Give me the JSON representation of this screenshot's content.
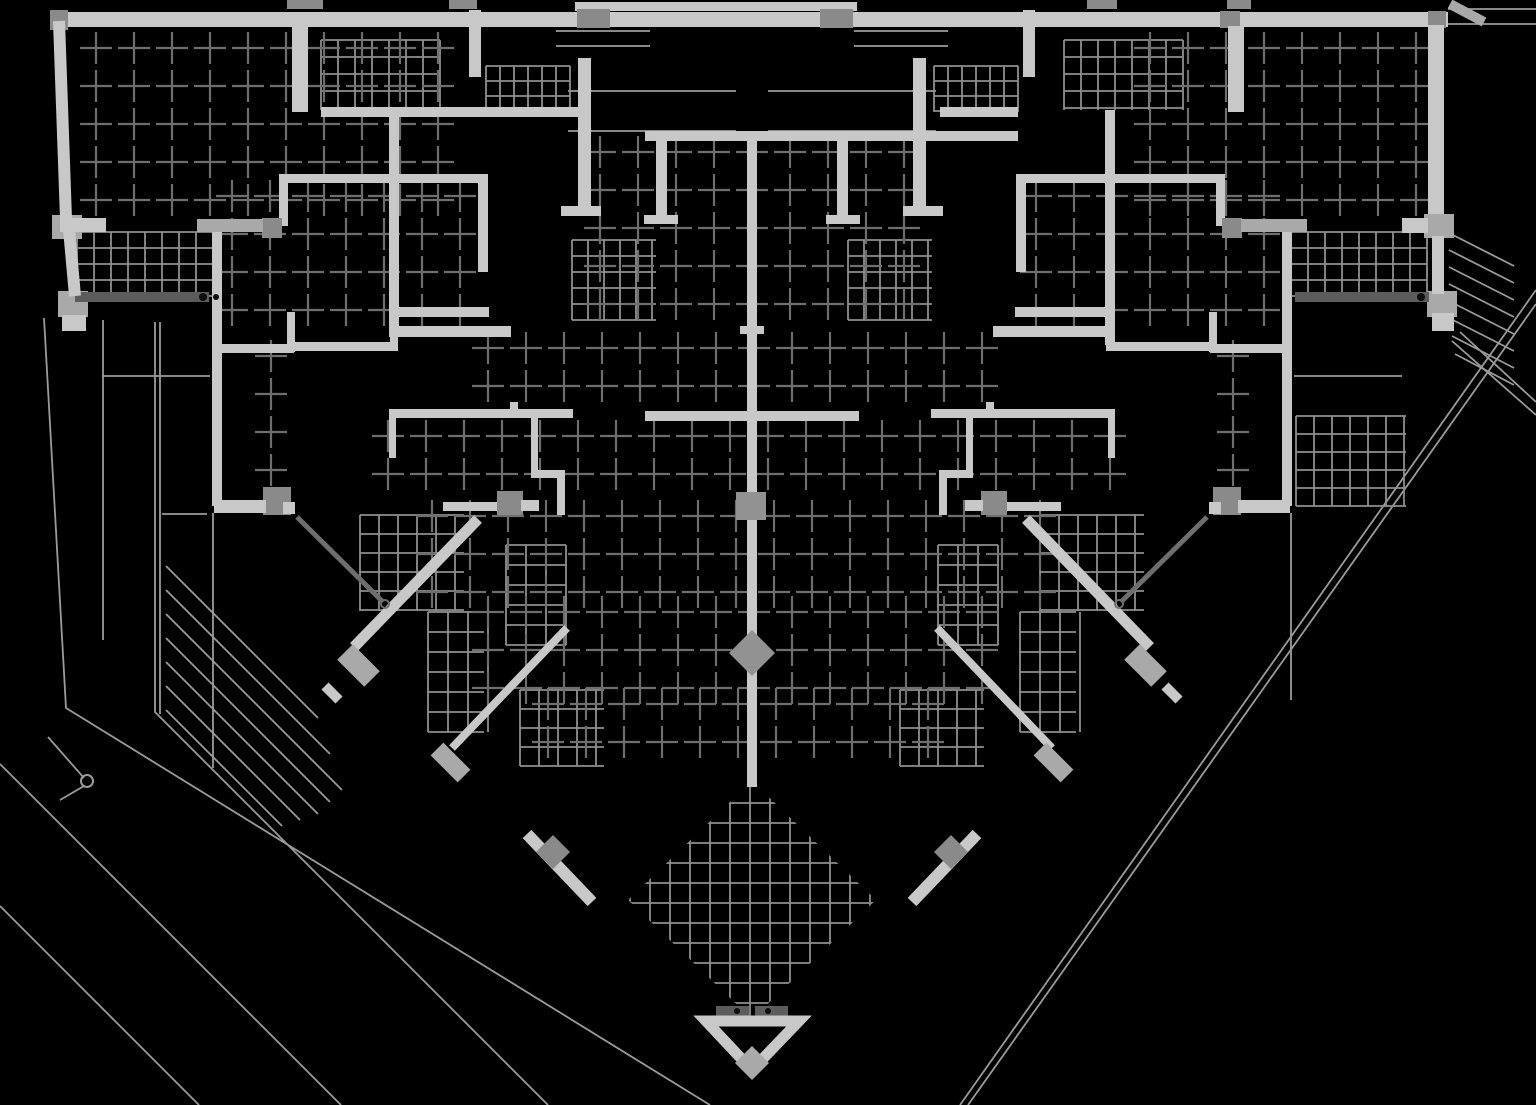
{
  "meta": {
    "drawing_type": "architectural-floor-plan",
    "style": "cad-inverted-white-on-black"
  },
  "canvas": {
    "w": 1536,
    "h": 1105,
    "bg": "#000000"
  },
  "palette": {
    "bg": "#000000",
    "wall": "#c8c8c8",
    "wallDim": "#a9a9a9",
    "joint": "#8a8a8a",
    "rail": "#5c5c5c",
    "node": "#929292",
    "mesh": "#8f8f8f",
    "cross": "#6e6e6e",
    "thin": "#9b9b9b",
    "door": "#6e6e6e",
    "dot": "#0d0d0d"
  },
  "plan": {
    "rects": [
      [
        50,
        12,
        1398,
        15,
        "w"
      ],
      [
        575,
        2,
        282,
        9,
        "w"
      ],
      [
        287,
        0,
        36,
        9,
        "j"
      ],
      [
        449,
        0,
        28,
        9,
        "j"
      ],
      [
        1087,
        0,
        30,
        9,
        "j"
      ],
      [
        1227,
        0,
        24,
        9,
        "j"
      ],
      [
        50,
        10,
        18,
        20,
        "j"
      ],
      [
        577,
        9,
        33,
        19,
        "j"
      ],
      [
        820,
        9,
        33,
        19,
        "j"
      ],
      [
        1220,
        11,
        20,
        17,
        "j"
      ],
      [
        1428,
        11,
        18,
        17,
        "j"
      ],
      [
        52,
        215,
        30,
        24,
        "d"
      ],
      [
        58,
        291,
        30,
        26,
        "d"
      ],
      [
        62,
        315,
        24,
        16,
        "w"
      ],
      [
        60,
        218,
        46,
        14,
        "w"
      ],
      [
        1428,
        25,
        16,
        196,
        "w"
      ],
      [
        1424,
        214,
        30,
        24,
        "d"
      ],
      [
        1427,
        291,
        30,
        26,
        "d"
      ],
      [
        1432,
        313,
        22,
        18,
        "w"
      ],
      [
        1402,
        218,
        26,
        15,
        "w"
      ],
      [
        1432,
        236,
        12,
        58,
        "w"
      ],
      [
        292,
        26,
        16,
        86,
        "w"
      ],
      [
        1228,
        26,
        16,
        86,
        "w"
      ],
      [
        321,
        107,
        268,
        10,
        "w"
      ],
      [
        940,
        107,
        78,
        10,
        "w"
      ],
      [
        389,
        110,
        10,
        227,
        "w"
      ],
      [
        1105,
        110,
        10,
        235,
        "w"
      ],
      [
        469,
        10,
        12,
        67,
        "w"
      ],
      [
        1023,
        10,
        12,
        67,
        "w"
      ],
      [
        578,
        58,
        13,
        154,
        "w"
      ],
      [
        913,
        58,
        13,
        154,
        "w"
      ],
      [
        561,
        206,
        40,
        10,
        "w"
      ],
      [
        903,
        206,
        40,
        10,
        "w"
      ],
      [
        645,
        131,
        212,
        10,
        "w"
      ],
      [
        857,
        131,
        161,
        10,
        "w"
      ],
      [
        656,
        141,
        11,
        78,
        "w"
      ],
      [
        837,
        141,
        11,
        78,
        "w"
      ],
      [
        644,
        215,
        34,
        9,
        "w"
      ],
      [
        826,
        215,
        34,
        9,
        "w"
      ],
      [
        747,
        141,
        10,
        190,
        "w"
      ],
      [
        389,
        326,
        122,
        11,
        "w"
      ],
      [
        993,
        326,
        122,
        11,
        "w"
      ],
      [
        212,
        222,
        10,
        284,
        "w"
      ],
      [
        1282,
        222,
        10,
        284,
        "w"
      ],
      [
        212,
        344,
        82,
        9,
        "w"
      ],
      [
        1210,
        344,
        82,
        9,
        "w"
      ],
      [
        287,
        312,
        8,
        40,
        "w"
      ],
      [
        1209,
        312,
        8,
        40,
        "w"
      ],
      [
        293,
        342,
        105,
        9,
        "w"
      ],
      [
        1106,
        342,
        105,
        9,
        "w"
      ],
      [
        390,
        307,
        8,
        44,
        "w"
      ],
      [
        1106,
        307,
        8,
        44,
        "w"
      ],
      [
        390,
        307,
        99,
        10,
        "w"
      ],
      [
        1015,
        307,
        99,
        10,
        "w"
      ],
      [
        279,
        174,
        208,
        9,
        "w"
      ],
      [
        1017,
        174,
        208,
        9,
        "w"
      ],
      [
        279,
        174,
        9,
        52,
        "w"
      ],
      [
        1216,
        174,
        9,
        52,
        "w"
      ],
      [
        478,
        174,
        10,
        98,
        "w"
      ],
      [
        1016,
        174,
        10,
        98,
        "w"
      ],
      [
        262,
        218,
        20,
        20,
        "j"
      ],
      [
        1222,
        218,
        20,
        20,
        "j"
      ],
      [
        197,
        219,
        66,
        13,
        "d"
      ],
      [
        1241,
        219,
        66,
        13,
        "d"
      ],
      [
        645,
        411,
        214,
        10,
        "w"
      ],
      [
        389,
        409,
        184,
        9,
        "w"
      ],
      [
        931,
        409,
        184,
        9,
        "w"
      ],
      [
        389,
        413,
        7,
        45,
        "w"
      ],
      [
        1108,
        413,
        7,
        45,
        "w"
      ],
      [
        510,
        402,
        8,
        9,
        "w"
      ],
      [
        986,
        402,
        8,
        9,
        "w"
      ],
      [
        531,
        418,
        7,
        55,
        "w"
      ],
      [
        966,
        418,
        7,
        55,
        "w"
      ],
      [
        531,
        470,
        33,
        8,
        "w"
      ],
      [
        940,
        470,
        33,
        8,
        "w"
      ],
      [
        557,
        470,
        8,
        45,
        "w"
      ],
      [
        939,
        470,
        8,
        45,
        "w"
      ],
      [
        443,
        502,
        58,
        9,
        "w"
      ],
      [
        1003,
        502,
        58,
        9,
        "w"
      ],
      [
        497,
        491,
        26,
        24,
        "j"
      ],
      [
        981,
        491,
        26,
        24,
        "j"
      ],
      [
        521,
        500,
        18,
        11,
        "w"
      ],
      [
        965,
        500,
        18,
        11,
        "w"
      ],
      [
        263,
        487,
        28,
        28,
        "j"
      ],
      [
        1213,
        487,
        28,
        28,
        "j"
      ],
      [
        214,
        500,
        52,
        13,
        "w"
      ],
      [
        1238,
        500,
        52,
        13,
        "w"
      ],
      [
        283,
        502,
        12,
        12,
        "w"
      ],
      [
        1209,
        502,
        12,
        12,
        "w"
      ],
      [
        747,
        331,
        10,
        456,
        "w"
      ],
      [
        736,
        492,
        30,
        28,
        "n"
      ],
      [
        740,
        326,
        24,
        8,
        "w"
      ],
      [
        75,
        292,
        134,
        10,
        "r"
      ],
      [
        1295,
        292,
        134,
        10,
        "r"
      ],
      [
        716,
        1006,
        33,
        10,
        "r"
      ],
      [
        755,
        1006,
        33,
        10,
        "r"
      ]
    ],
    "segs": [
      [
        59,
        21,
        66,
        219,
        12,
        "w"
      ],
      [
        69,
        229,
        75,
        296,
        12,
        "w"
      ],
      [
        297,
        517,
        383,
        602,
        5,
        "door"
      ],
      [
        1207,
        517,
        1121,
        602,
        5,
        "door"
      ],
      [
        478,
        519,
        354,
        647,
        11,
        "w"
      ],
      [
        1026,
        519,
        1150,
        647,
        11,
        "w"
      ],
      [
        345,
        652,
        372,
        679,
        22,
        "d"
      ],
      [
        1132,
        652,
        1159,
        679,
        22,
        "d"
      ],
      [
        325,
        686,
        339,
        700,
        10,
        "w"
      ],
      [
        1165,
        686,
        1179,
        700,
        10,
        "w"
      ],
      [
        567,
        628,
        452,
        748,
        8,
        "w"
      ],
      [
        937,
        628,
        1052,
        748,
        8,
        "w"
      ],
      [
        437,
        749,
        464,
        776,
        18,
        "d"
      ],
      [
        1040,
        749,
        1067,
        776,
        18,
        "d"
      ],
      [
        527,
        834,
        592,
        902,
        12,
        "w"
      ],
      [
        977,
        834,
        912,
        902,
        12,
        "w"
      ],
      [
        1450,
        4,
        1484,
        22,
        10,
        "d"
      ]
    ],
    "polygons": [
      {
        "pts": [
          [
            706,
            1021
          ],
          [
            799,
            1021
          ],
          [
            752,
            1070
          ]
        ],
        "stroke": "wall",
        "sw": 11,
        "fill": "none"
      },
      {
        "pts": [
          [
            752,
            1046
          ],
          [
            769,
            1063
          ],
          [
            752,
            1080
          ],
          [
            735,
            1063
          ]
        ],
        "fill": "wallDim"
      },
      {
        "pts": [
          [
            752,
            630
          ],
          [
            775,
            653
          ],
          [
            752,
            676
          ],
          [
            729,
            653
          ]
        ],
        "fill": "node"
      },
      {
        "pts": [
          [
            553,
            835
          ],
          [
            570,
            852
          ],
          [
            553,
            869
          ],
          [
            536,
            852
          ]
        ],
        "fill": "joint"
      },
      {
        "pts": [
          [
            951,
            835
          ],
          [
            968,
            852
          ],
          [
            951,
            869
          ],
          [
            934,
            852
          ]
        ],
        "fill": "joint"
      }
    ],
    "meshes": [
      [
        77,
        232,
        136,
        64,
        17,
        16
      ],
      [
        1291,
        232,
        136,
        64,
        17,
        16
      ],
      [
        321,
        40,
        119,
        70,
        17,
        17
      ],
      [
        1064,
        40,
        119,
        70,
        17,
        17
      ],
      [
        486,
        66,
        84,
        46,
        14,
        15
      ],
      [
        934,
        66,
        84,
        46,
        14,
        15
      ],
      [
        572,
        240,
        84,
        80,
        16,
        16
      ],
      [
        848,
        240,
        84,
        80,
        16,
        16
      ],
      [
        360,
        515,
        104,
        96,
        19,
        19
      ],
      [
        1040,
        515,
        104,
        96,
        19,
        19
      ],
      [
        506,
        545,
        60,
        100,
        20,
        20
      ],
      [
        938,
        545,
        60,
        100,
        20,
        20
      ],
      [
        428,
        612,
        56,
        120,
        20,
        20
      ],
      [
        1020,
        612,
        56,
        120,
        20,
        20
      ],
      [
        1296,
        416,
        110,
        90,
        18,
        18
      ],
      [
        520,
        690,
        84,
        76,
        19,
        19
      ],
      [
        900,
        690,
        84,
        76,
        19,
        19
      ]
    ],
    "diamond_mesh": {
      "bbox": [
        630,
        783,
        244,
        234
      ],
      "cell": 20,
      "clip": [
        [
          752,
          781
        ],
        [
          876,
          900
        ],
        [
          752,
          1019
        ],
        [
          628,
          900
        ]
      ]
    },
    "crosses": [
      [
        96,
        48,
        376,
        160
      ],
      [
        1150,
        48,
        280,
        160
      ],
      [
        232,
        196,
        236,
        136
      ],
      [
        1036,
        196,
        236,
        136
      ],
      [
        600,
        152,
        320,
        168
      ],
      [
        488,
        348,
        528,
        56
      ],
      [
        388,
        436,
        728,
        64
      ],
      [
        432,
        516,
        640,
        84
      ],
      [
        488,
        612,
        528,
        80
      ],
      [
        548,
        704,
        408,
        64
      ],
      [
        271,
        356,
        2,
        150
      ],
      [
        1233,
        356,
        2,
        150
      ]
    ],
    "thin_polylines": [
      [
        [
          44,
          318
        ],
        [
          66,
          708
        ],
        [
          710,
          1105
        ]
      ],
      [
        [
          103,
          320
        ],
        [
          103,
          640
        ]
      ],
      [
        [
          155,
          322
        ],
        [
          155,
          712
        ],
        [
          548,
          1105
        ]
      ],
      [
        [
          160,
          322
        ],
        [
          160,
          714
        ]
      ],
      [
        [
          0,
          764
        ],
        [
          341,
          1105
        ]
      ],
      [
        [
          0,
          906
        ],
        [
          199,
          1105
        ]
      ],
      [
        [
          213,
          513
        ],
        [
          213,
          768
        ]
      ],
      [
        [
          1291,
          513
        ],
        [
          1291,
          700
        ]
      ],
      [
        [
          1448,
          9
        ],
        [
          1536,
          9
        ]
      ],
      [
        [
          1448,
          24
        ],
        [
          1536,
          24
        ]
      ],
      [
        [
          1536,
          290
        ],
        [
          960,
          1105
        ]
      ],
      [
        [
          1536,
          304
        ],
        [
          968,
          1105
        ]
      ],
      [
        [
          1460,
          332
        ],
        [
          1536,
          402
        ]
      ],
      [
        [
          1452,
          341
        ],
        [
          1536,
          415
        ]
      ],
      [
        [
          48,
          737
        ],
        [
          84,
          778
        ]
      ],
      [
        [
          60,
          800
        ],
        [
          84,
          786
        ]
      ],
      [
        [
          854,
          31
        ],
        [
          948,
          31
        ]
      ],
      [
        [
          854,
          46
        ],
        [
          948,
          46
        ]
      ],
      [
        [
          556,
          31
        ],
        [
          650,
          31
        ]
      ],
      [
        [
          556,
          46
        ],
        [
          650,
          46
        ]
      ],
      [
        [
          768,
          91
        ],
        [
          936,
          91
        ]
      ],
      [
        [
          768,
          131
        ],
        [
          936,
          131
        ]
      ],
      [
        [
          568,
          91
        ],
        [
          736,
          91
        ]
      ],
      [
        [
          568,
          131
        ],
        [
          736,
          131
        ]
      ],
      [
        [
          102,
          376
        ],
        [
          210,
          376
        ]
      ],
      [
        [
          162,
          514
        ],
        [
          207,
          514
        ]
      ],
      [
        [
          1294,
          376
        ],
        [
          1402,
          376
        ]
      ],
      [
        [
          166,
          566
        ],
        [
          318,
          718
        ]
      ],
      [
        [
          166,
          590
        ],
        [
          330,
          754
        ]
      ],
      [
        [
          166,
          614
        ],
        [
          342,
          790
        ]
      ],
      [
        [
          166,
          638
        ],
        [
          330,
          802
        ]
      ],
      [
        [
          166,
          662
        ],
        [
          318,
          814
        ]
      ],
      [
        [
          166,
          686
        ],
        [
          300,
          820
        ]
      ],
      [
        [
          166,
          710
        ],
        [
          282,
          826
        ]
      ],
      [
        [
          1449,
          233
        ],
        [
          1514,
          266
        ]
      ],
      [
        [
          1449,
          250
        ],
        [
          1514,
          283
        ]
      ],
      [
        [
          1449,
          267
        ],
        [
          1514,
          300
        ]
      ],
      [
        [
          1449,
          284
        ],
        [
          1514,
          317
        ]
      ],
      [
        [
          1449,
          301
        ],
        [
          1514,
          334
        ]
      ],
      [
        [
          1449,
          318
        ],
        [
          1514,
          351
        ]
      ],
      [
        [
          1452,
          336
        ],
        [
          1514,
          368
        ]
      ],
      [
        [
          1455,
          354
        ],
        [
          1514,
          385
        ]
      ]
    ],
    "circles": [
      {
        "c": [
          87,
          781,
          6
        ],
        "stroke": "thin"
      },
      {
        "c": [
          385,
          604,
          4
        ],
        "stroke": "door"
      },
      {
        "c": [
          1119,
          604,
          4
        ],
        "stroke": "door"
      }
    ],
    "dots": [
      [
        203,
        297,
        4
      ],
      [
        1421,
        297,
        4
      ],
      [
        216,
        297,
        3
      ],
      [
        737,
        1011,
        3
      ],
      [
        768,
        1011,
        3
      ]
    ]
  }
}
